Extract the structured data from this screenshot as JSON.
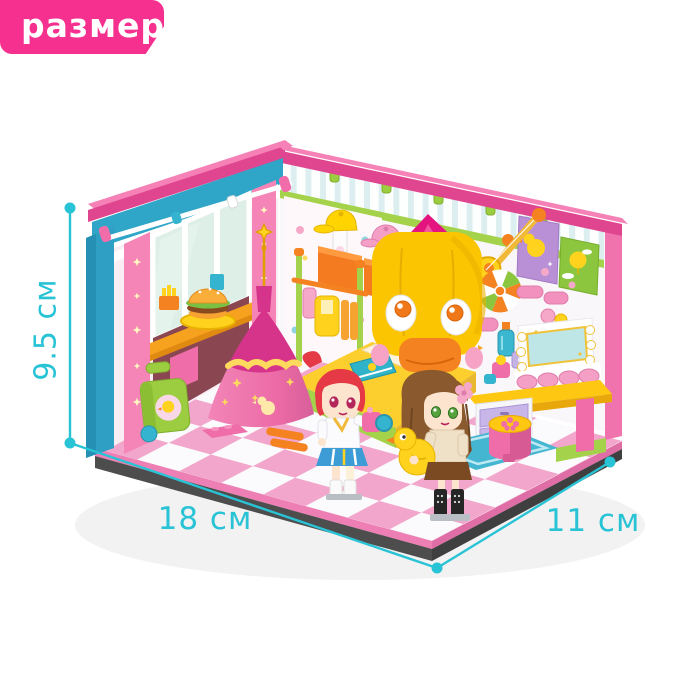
{
  "badge": {
    "label": "размер"
  },
  "dimensions": {
    "height": {
      "label": "9.5 см"
    },
    "width": {
      "label": "18 см"
    },
    "depth": {
      "label": "11 см"
    }
  },
  "palette": {
    "accent_cyan": "#29c3d6",
    "badge_pink": "#f5308f",
    "badge_text": "#ffffff",
    "rim_pink": "#e0458f",
    "wall_blue": "#2fa6c8",
    "duck_yellow": "#fcc502",
    "floor_pink": "#f2a6cb",
    "tent_pink": "#ef7ab0"
  }
}
